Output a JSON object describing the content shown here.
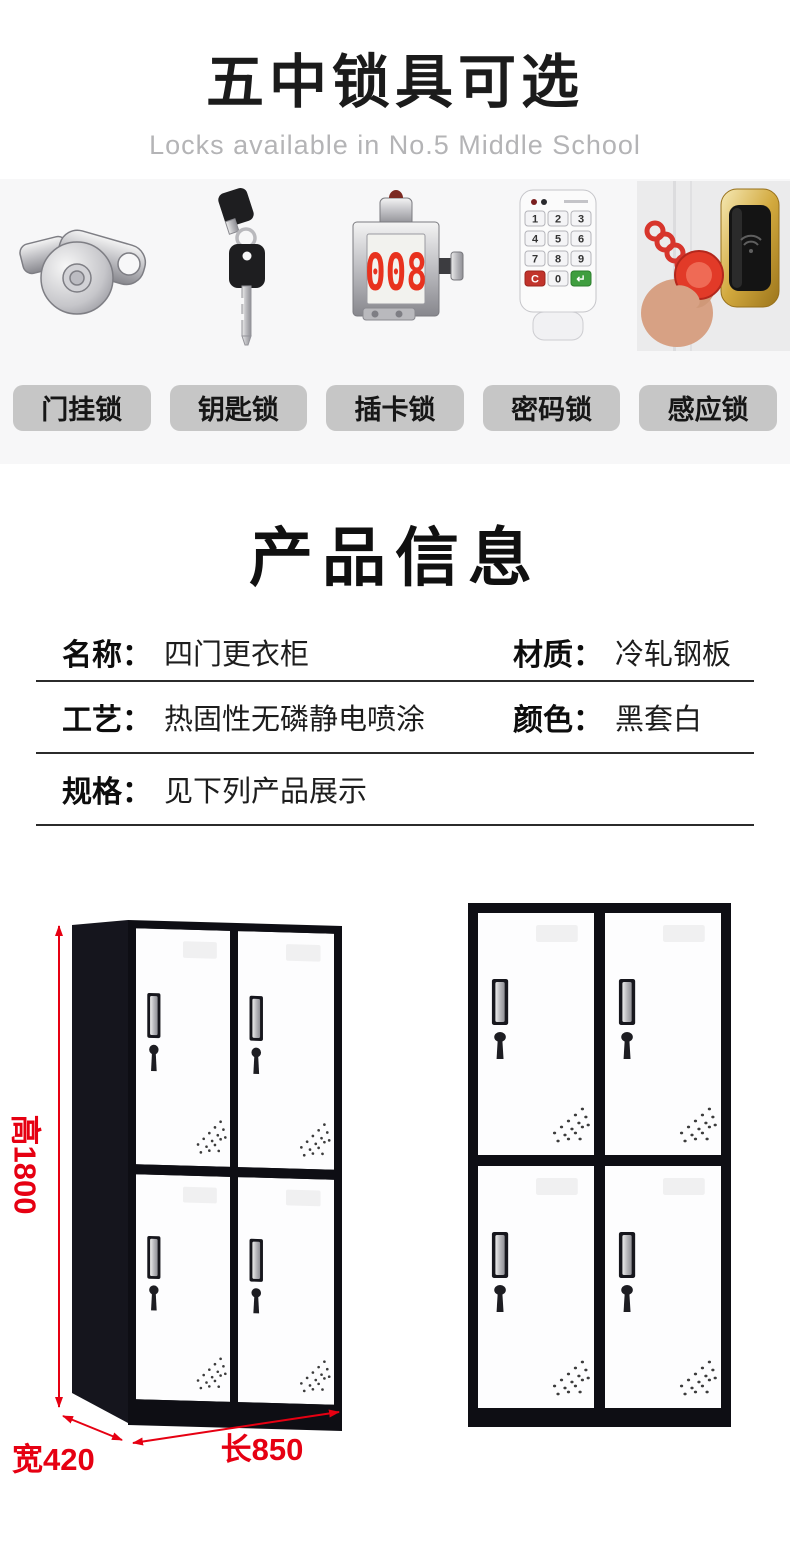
{
  "header": {
    "title": "五中锁具可选",
    "subtitle": "Locks available in No.5 Middle School"
  },
  "locks": {
    "labels": [
      "门挂锁",
      "钥匙锁",
      "插卡锁",
      "密码锁",
      "感应锁"
    ],
    "card_display": "008",
    "keypad": [
      "1",
      "2",
      "3",
      "4",
      "5",
      "6",
      "7",
      "8",
      "9",
      "C",
      "0",
      "↵"
    ]
  },
  "info": {
    "title": "产品信息",
    "name_label": "名称：",
    "name_value": "四门更衣柜",
    "material_label": "材质：",
    "material_value": "冷轧钢板",
    "process_label": "工艺：",
    "process_value": "热固性无磷静电喷涂",
    "color_label": "颜色：",
    "color_value": "黑套白",
    "spec_label": "规格：",
    "spec_value": "见下列产品展示"
  },
  "dimensions": {
    "height": "高1800",
    "width": "宽420",
    "length": "长850"
  },
  "colors": {
    "accent_red": "#e60012",
    "pill_bg": "#c6c6c6",
    "band_bg": "#f7f7f8",
    "cabinet_black": "#0e0e14",
    "gold": "#d2a93e"
  }
}
